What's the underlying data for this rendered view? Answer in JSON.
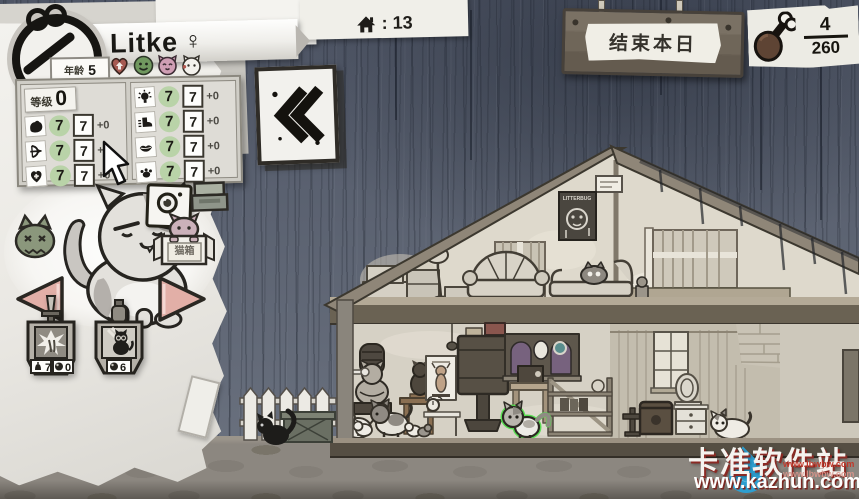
{
  "character": {
    "name": "Litke",
    "gender": "♀",
    "age_label": "年龄",
    "age_value": "5",
    "level_label": "等级",
    "level_value": "0",
    "stats_left": [
      {
        "icon": "muscle-icon",
        "base": "7",
        "value": "7",
        "mod": "+0"
      },
      {
        "icon": "bow-icon",
        "base": "7",
        "value": "7",
        "mod": "+0"
      },
      {
        "icon": "heart-icon",
        "base": "7",
        "value": "7",
        "mod": "+0"
      }
    ],
    "stats_right": [
      {
        "icon": "bulb-icon",
        "base": "7",
        "value": "7",
        "mod": "+0"
      },
      {
        "icon": "foot-icon",
        "base": "7",
        "value": "7",
        "mod": "+0"
      },
      {
        "icon": "lips-icon",
        "base": "7",
        "value": "7",
        "mod": "+0"
      },
      {
        "icon": "paw-icon",
        "base": "7",
        "value": "7",
        "mod": "+0"
      }
    ],
    "mood_icons": [
      "heart-up",
      "smiley",
      "cat-happy",
      "cat-heart"
    ]
  },
  "topbar": {
    "date_text": "月23日 周三",
    "house_count": ": 13",
    "end_day_label": "结束本日",
    "food_numerator": "4",
    "food_denominator": "260"
  },
  "panel_buttons": {
    "catbox_label": "猫箱"
  },
  "ability_tags": [
    {
      "top_icon": "sword-icon",
      "counters": [
        {
          "icon": "bell-icon",
          "value": "7"
        },
        {
          "icon": "orb-icon",
          "value": "0"
        }
      ]
    },
    {
      "top_icon": "bottle-icon",
      "counters": [
        {
          "icon": "orb-icon",
          "value": "6"
        }
      ]
    }
  ],
  "attic_poster_label": "LITTERBUG",
  "watermark": {
    "site_name": "卡准软件站",
    "url": "www.kazhun.com",
    "mirror_url": "www.lbwbw.com"
  }
}
